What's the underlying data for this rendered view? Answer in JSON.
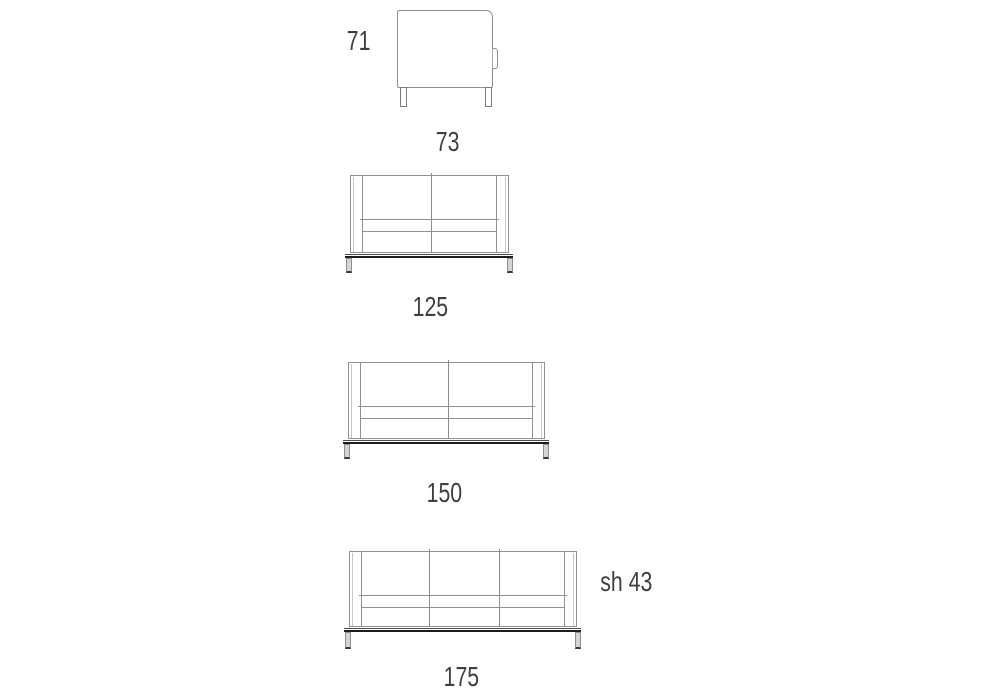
{
  "page": {
    "type": "furniture-dimension-diagram",
    "background": "#ffffff"
  },
  "colors": {
    "line": "#919191",
    "line_light": "#c6c6c6",
    "rail_dark": "#1d1d1d",
    "text": "#3f3f3f"
  },
  "drawings": {
    "side_view": {
      "name": "armchair-side-profile",
      "height_label": "71",
      "depth_label": "73"
    },
    "sofa_125": {
      "name": "two-seat-sofa-front",
      "width_label": "125"
    },
    "sofa_150": {
      "name": "two-seat-sofa-front-wide",
      "width_label": "150"
    },
    "sofa_175": {
      "name": "three-seat-sofa-front",
      "width_label": "175",
      "seat_height_label": "sh 43"
    }
  }
}
